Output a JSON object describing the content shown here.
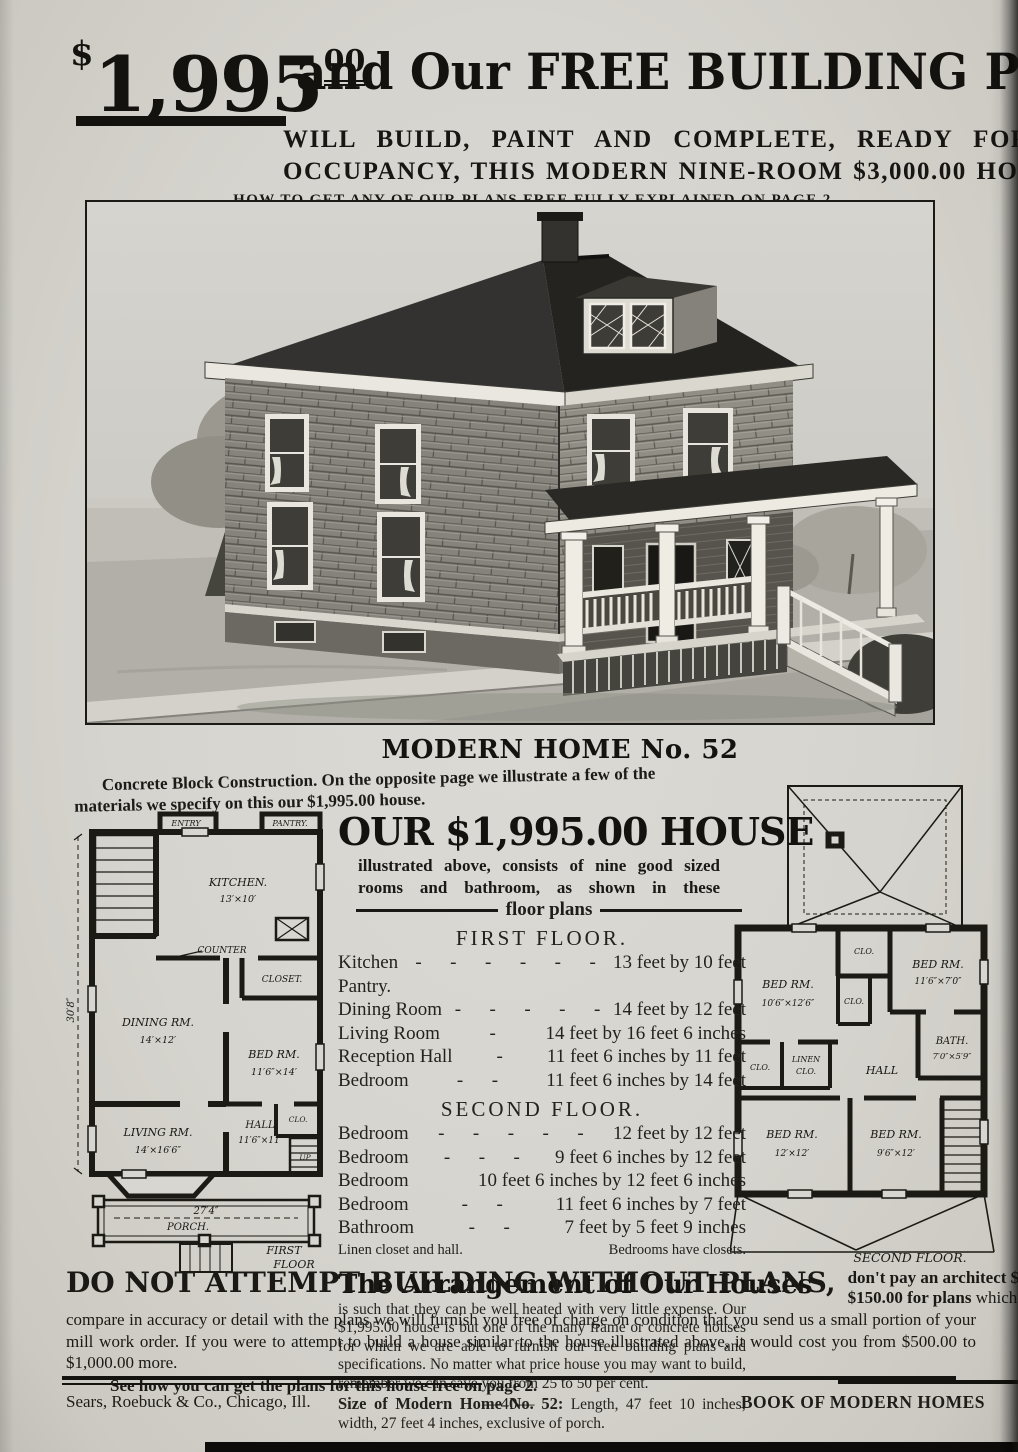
{
  "colors": {
    "paper": "#d8d6d0",
    "ink": "#14120f"
  },
  "headline": {
    "dollar": "$",
    "price": "1,995",
    "cents": "00",
    "rest": "and Our FREE BUILDING PLANS",
    "sub1": "WILL BUILD, PAINT AND COMPLETE, READY FOR",
    "sub2": "OCCUPANCY, THIS MODERN NINE-ROOM $3,000.00 HOUSE",
    "note": "HOW TO GET ANY OF OUR PLANS FREE FULLY EXPLAINED ON PAGE 2."
  },
  "home": {
    "title": "MODERN HOME No. 52",
    "intro": "Concrete Block Construction.  On the opposite page we illustrate a few of the materials we specify on this our $1,995.00 house."
  },
  "offer": {
    "title": "OUR $1,995.00 HOUSE",
    "sub1": "illustrated above, consists of nine good sized",
    "sub2": "rooms and bathroom, as shown in these",
    "divider_label": "floor plans"
  },
  "first_floor": {
    "heading": "FIRST FLOOR.",
    "rooms": [
      {
        "name": "Kitchen",
        "dashes": "-      -      -      -      -      -",
        "dim": "13 feet by 10 feet"
      },
      {
        "name": "Pantry.",
        "dashes": "",
        "dim": ""
      },
      {
        "name": "Dining Room",
        "dashes": "-      -      -      -      -",
        "dim": "14 feet by 12 feet"
      },
      {
        "name": "Living Room",
        "dashes": "-",
        "dim": "14 feet by 16 feet 6 inches"
      },
      {
        "name": "Reception Hall",
        "dashes": "-",
        "dim": "11 feet 6 inches by 11 feet"
      },
      {
        "name": "Bedroom",
        "dashes": "-      -",
        "dim": "11 feet 6 inches by 14 feet"
      }
    ]
  },
  "second_floor": {
    "heading": "SECOND FLOOR.",
    "rooms": [
      {
        "name": "Bedroom",
        "dashes": "-      -      -      -      -",
        "dim": "12 feet by 12 feet"
      },
      {
        "name": "Bedroom",
        "dashes": "-      -      -",
        "dim": "9 feet 6 inches by 12 feet"
      },
      {
        "name": "Bedroom",
        "dashes": "",
        "dim": "10 feet 6 inches by 12 feet 6 inches"
      },
      {
        "name": "Bedroom",
        "dashes": "-      -",
        "dim": "11 feet 6 inches by 7 feet"
      },
      {
        "name": "Bathroom",
        "dashes": "-      -",
        "dim": "7 feet by 5 feet 9 inches"
      }
    ],
    "footnote_left": "Linen closet and hall.",
    "footnote_right": "Bedrooms have closets."
  },
  "arrangement": {
    "title": "The Arrangement of Our Houses",
    "body": "is such that they can be well heated with very little expense.  Our $1,995.00 house is but one of the many frame or concrete houses for which we are able to furnish our free building plans and specifications.  No matter what price house you may want to build, remember we can save you from 25 to 50 per cent.",
    "size_label": "Size of Modern Home No. 52:",
    "size_text": "Length, 47 feet 10 inches; width, 27 feet 4 inches, exclusive of porch."
  },
  "warning": {
    "lead": "DO NOT ATTEMPT BUILDING WITHOUT PLANS,",
    "right1": "don't pay an architect $100.00 or",
    "right2_bold": "$150.00 for plans",
    "right2_rest": " which in no way",
    "body": "compare in accuracy or detail with the plans we will furnish you free of charge on condition that you send us a small portion of your mill work order.  If you were to attempt to build a house similar to the house illustrated above, it would cost you from $500.00 to $1,000.00 more.",
    "see": "See how you can get the plans for this house free on page 2."
  },
  "footer": {
    "left": "Sears, Roebuck & Co., Chicago, Ill.",
    "center": "—40—",
    "right": "BOOK OF MODERN HOMES"
  },
  "plan_first": {
    "labels": {
      "entry": "ENTRY",
      "pantry": "PANTRY.",
      "kitchen": "KITCHEN.",
      "kitchen_dim": "13′×10′",
      "counter": "COUNTER",
      "closet": "CLOSET.",
      "dining": "DINING RM.",
      "dining_dim": "14′×12′",
      "bed": "BED RM.",
      "bed_dim": "11′6″×14′",
      "living": "LIVING RM.",
      "living_dim": "14′×16′6″",
      "hall": "HALL",
      "hall_dim": "11′6″×11′",
      "clo": "CLO.",
      "up": "UP",
      "porch_dim": "27′4″",
      "porch": "PORCH.",
      "caption1": "FIRST",
      "caption2": "FLOOR",
      "side_dim": "30′8″"
    }
  },
  "plan_second": {
    "labels": {
      "clo_top": "CLO.",
      "bed_tr": "BED RM.",
      "bed_tr_dim": "11′6″×7′0″",
      "bed_tl": "BED RM.",
      "bed_tl_dim": "10′6″×12′6″",
      "clo_mid": "CLO.",
      "bath": "BATH.",
      "bath_dim": "7′0″×5′9″",
      "clo_left": "CLO.",
      "linen1": "LINEN",
      "linen2": "CLO.",
      "hall": "HALL",
      "bed_bl": "BED RM.",
      "bed_bl_dim": "12′×12′",
      "bed_bm": "BED RM.",
      "bed_bm_dim": "9′6″×12′",
      "caption": "SECOND FLOOR."
    }
  }
}
